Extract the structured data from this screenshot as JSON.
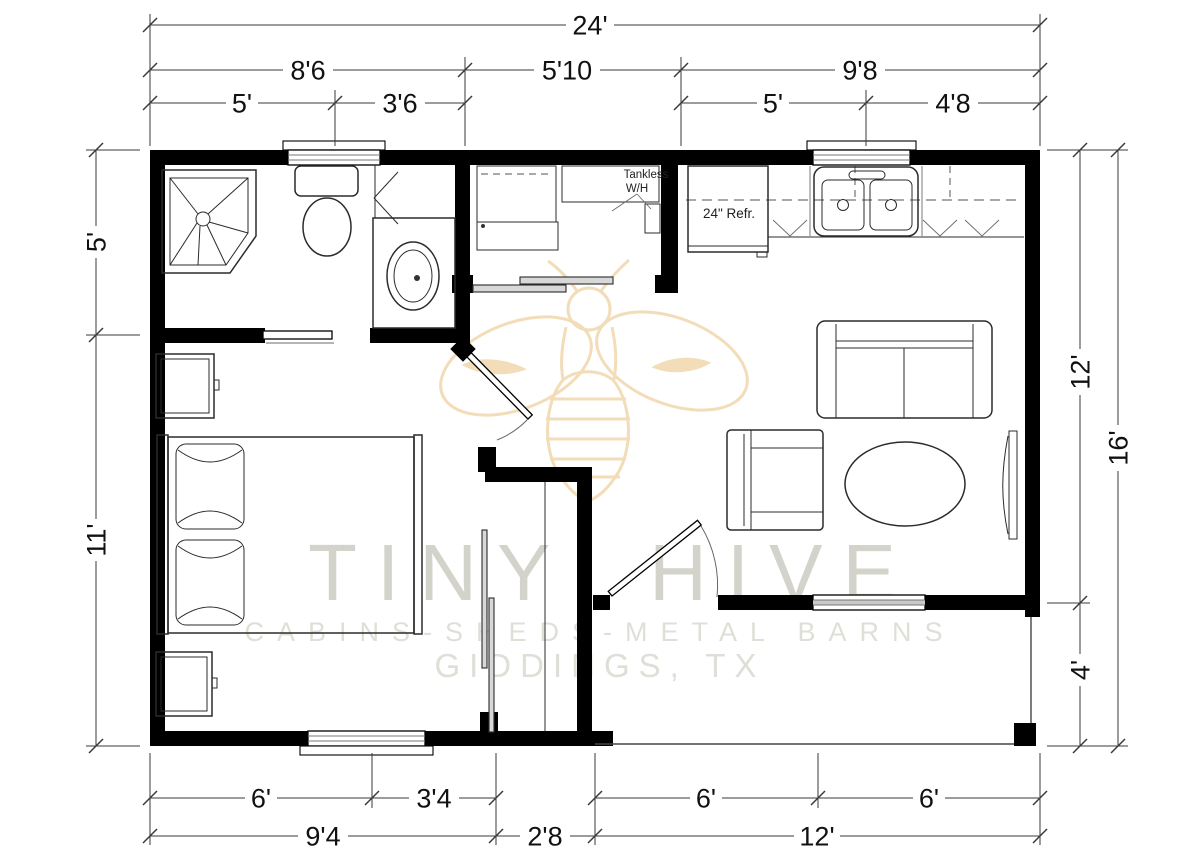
{
  "title": "Tiny Hive cabin floor plan",
  "watermark": {
    "brand": "TINY HIVE",
    "tagline": "CABINS-SHEDS-METAL BARNS",
    "location": "GIDDINGS, TX"
  },
  "labels": {
    "tankless_line1": "Tankless",
    "tankless_line2": "W/H",
    "refrigerator": "24\" Refr."
  },
  "dims": {
    "overall_width": "24'",
    "overall_height": "16'",
    "top_row2": [
      "8'6",
      "5'10",
      "9'8"
    ],
    "top_row3": [
      "5'",
      "3'6",
      "5'",
      "4'8"
    ],
    "bottom_row1": [
      "6'",
      "3'4",
      "6'",
      "6'"
    ],
    "bottom_row2": [
      "9'4",
      "2'8",
      "12'"
    ],
    "left": [
      "5'",
      "11'"
    ],
    "right": [
      "12'",
      "4'"
    ]
  },
  "colors": {
    "wall": "#000000",
    "bee": "#f2ddb8",
    "watermark_brand": "#d3d3cb",
    "watermark_light": "#dfdfd8",
    "dimension_text": "#111111"
  }
}
